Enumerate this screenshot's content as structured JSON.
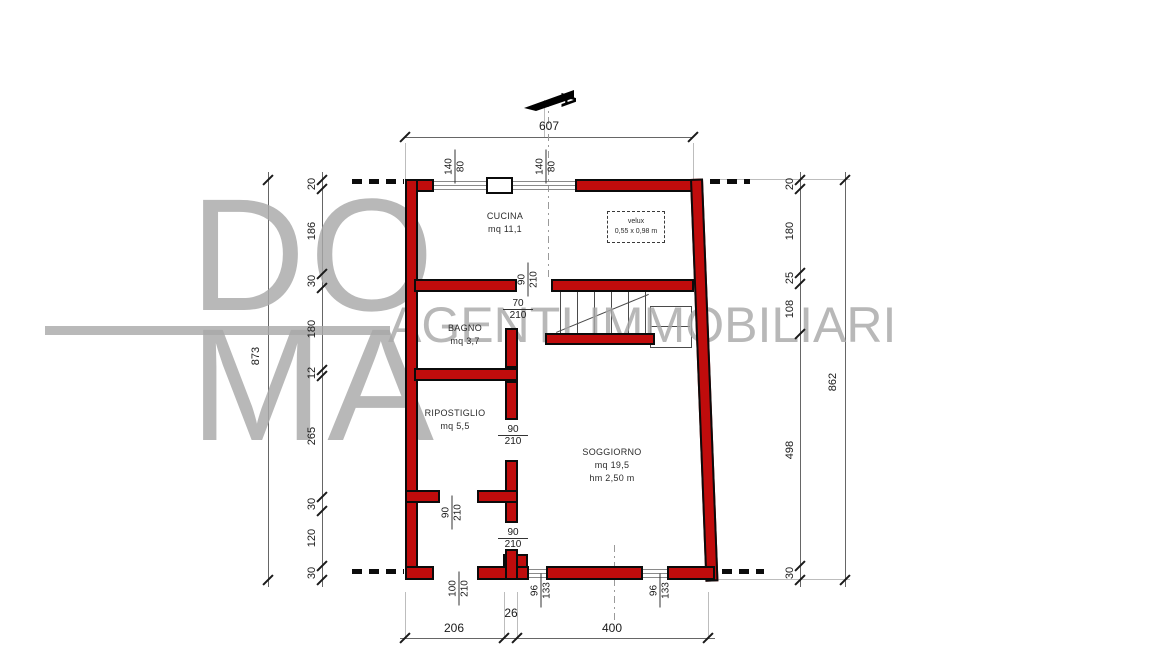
{
  "watermark": {
    "top": "DO",
    "bottom": "MA",
    "tagline": "AGENTI IMMOBILIARI"
  },
  "north": {
    "section_label": "A"
  },
  "rooms": {
    "cucina": {
      "name": "CUCINA",
      "area": "mq 11,1"
    },
    "bagno": {
      "name": "BAGNO",
      "area": "mq 3,7"
    },
    "ripostiglio": {
      "name": "RIPOSTIGLIO",
      "area": "mq 5,5"
    },
    "soggiorno": {
      "name": "SOGGIORNO",
      "area": "mq 19,5",
      "height": "hm 2,50 m"
    }
  },
  "velux": {
    "label": "velux",
    "size": "0,55 x 0,98 m"
  },
  "dims": {
    "top": "607",
    "bottom": {
      "a": "206",
      "b": "26",
      "c": "400"
    },
    "left_total": "873",
    "left_chain": [
      "20",
      "186",
      "30",
      "180",
      "12",
      "265",
      "30",
      "120",
      "30"
    ],
    "right_total": "862",
    "right_chain": [
      "20",
      "180",
      "25",
      "108",
      "498",
      "30"
    ]
  },
  "openings": {
    "win_top_1": {
      "num": "140",
      "den": "80"
    },
    "win_top_2": {
      "num": "140",
      "den": "80"
    },
    "door_cucina": {
      "num": "90",
      "den": "210"
    },
    "door_bagno": {
      "num": "70",
      "den": "210"
    },
    "door_ripostiglio": {
      "num": "90",
      "den": "210"
    },
    "door_corridoio": {
      "num": "90",
      "den": "210"
    },
    "door_soggiorno": {
      "num": "90",
      "den": "210"
    },
    "door_ingresso": {
      "num": "100",
      "den": "210"
    },
    "win_bottom_1": {
      "num": "96",
      "den": "133"
    },
    "win_bottom_2": {
      "num": "96",
      "den": "133"
    }
  },
  "colors": {
    "wall": "#c00c0c",
    "watermark": "#a9a9a9",
    "line": "#666666"
  }
}
